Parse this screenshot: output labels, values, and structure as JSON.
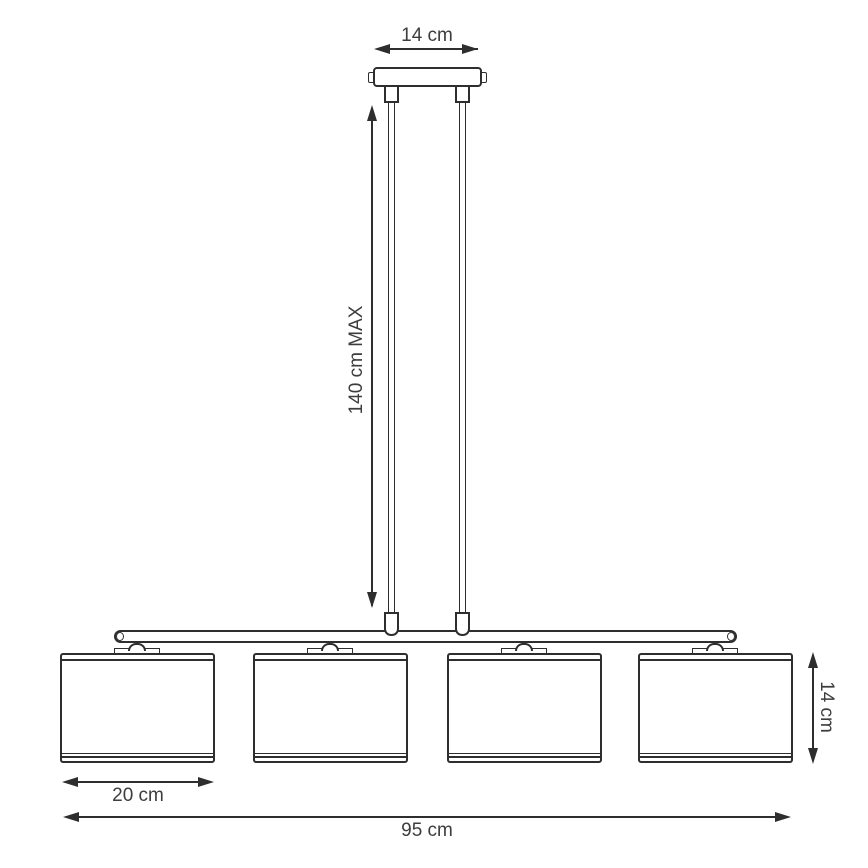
{
  "diagram": {
    "subject": "four-shade linear pendant lamp technical dimension drawing",
    "background": "#ffffff",
    "line_color": "#2e2e2e",
    "text_color": "#3d3d3d",
    "shade_count": 4,
    "dimensions": {
      "canopy_width": "14 cm",
      "max_drop": "140 cm MAX",
      "shade_height": "14 cm",
      "shade_width": "20 cm",
      "total_width": "95 cm"
    }
  }
}
